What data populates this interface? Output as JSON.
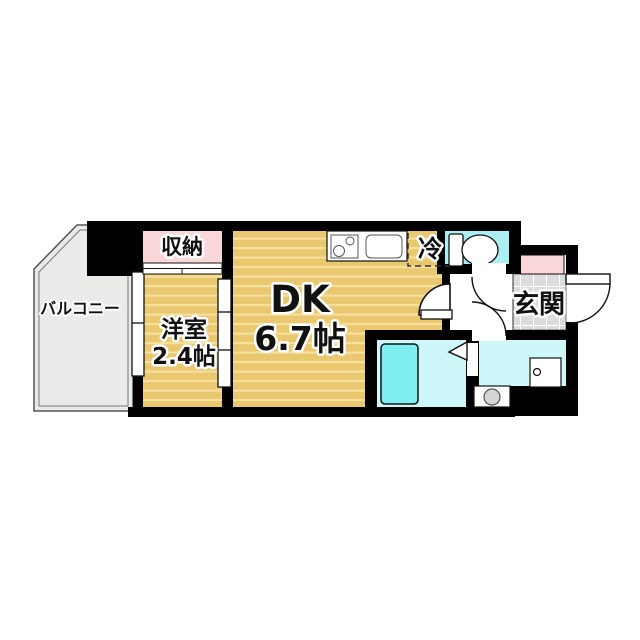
{
  "plan": {
    "rooms": {
      "balcony": "バルコニー",
      "closet": "収納",
      "western_room": {
        "name": "洋室",
        "size": "2.4帖"
      },
      "dining_kitchen": {
        "name": "DK",
        "size": "6.7帖"
      },
      "refrigerator": "冷",
      "entrance": "玄関"
    },
    "colors": {
      "wall": "#000000",
      "wood": "#e9c86f",
      "wood_stripe": "#f5e0a0",
      "pink": "#f9d6d7",
      "toilet_floor": "#aceff3",
      "wet_floor": "#cdf7f8",
      "bathtub": "#7deef1",
      "balcony": "#eaeae8",
      "tile": "#dcdcdc"
    }
  }
}
